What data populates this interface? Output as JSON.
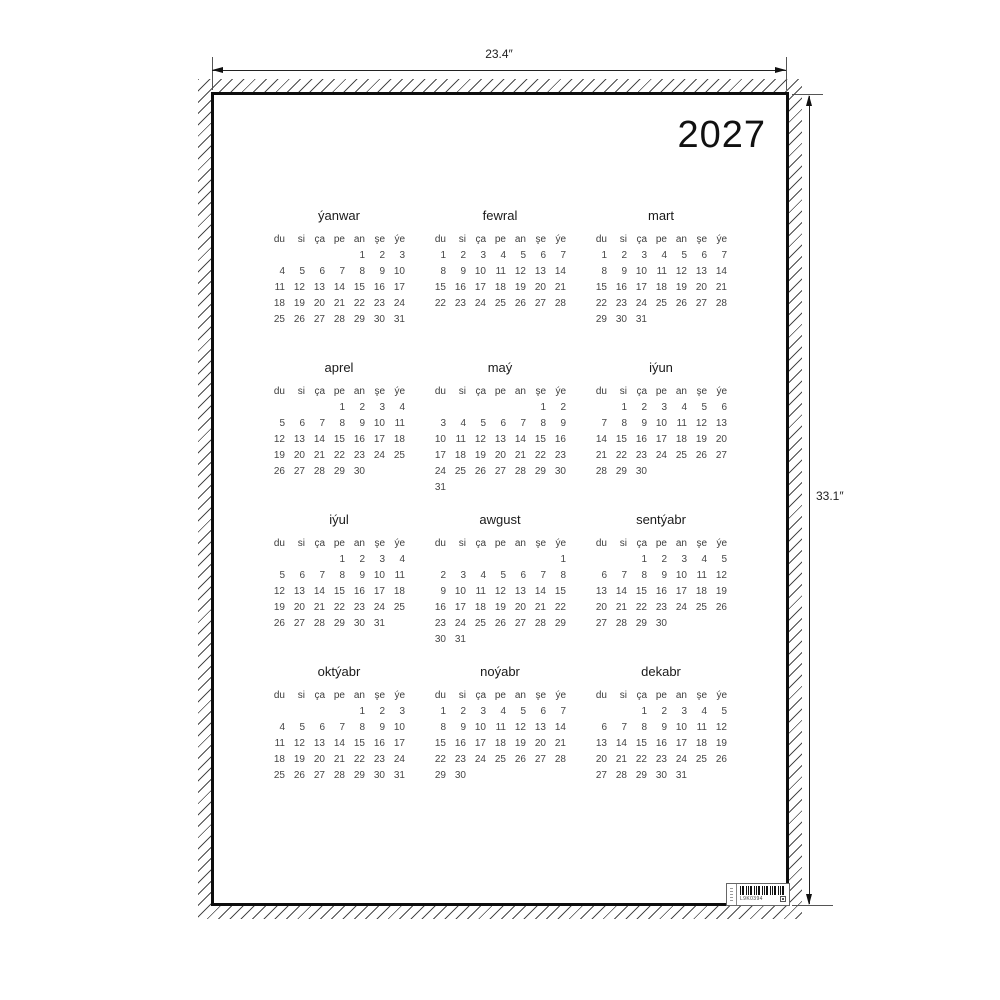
{
  "year": "2027",
  "dimension_labels": {
    "width": "23.4″",
    "height": "33.1″"
  },
  "day_headers": [
    "du",
    "si",
    "ça",
    "pe",
    "an",
    "şe",
    "ýe"
  ],
  "months": [
    {
      "name": "ýanwar",
      "start_col": 4,
      "num_days": 31
    },
    {
      "name": "fewral",
      "start_col": 0,
      "num_days": 28
    },
    {
      "name": "mart",
      "start_col": 0,
      "num_days": 31
    },
    {
      "name": "aprel",
      "start_col": 3,
      "num_days": 30
    },
    {
      "name": "maý",
      "start_col": 5,
      "num_days": 31
    },
    {
      "name": "iýun",
      "start_col": 1,
      "num_days": 30
    },
    {
      "name": "iýul",
      "start_col": 3,
      "num_days": 31
    },
    {
      "name": "awgust",
      "start_col": 6,
      "num_days": 31
    },
    {
      "name": "sentýabr",
      "start_col": 2,
      "num_days": 30
    },
    {
      "name": "oktýabr",
      "start_col": 4,
      "num_days": 31
    },
    {
      "name": "noýabr",
      "start_col": 0,
      "num_days": 30
    },
    {
      "name": "dekabr",
      "start_col": 2,
      "num_days": 31
    }
  ],
  "sticker": {
    "barcode_text": "L9K0394"
  }
}
